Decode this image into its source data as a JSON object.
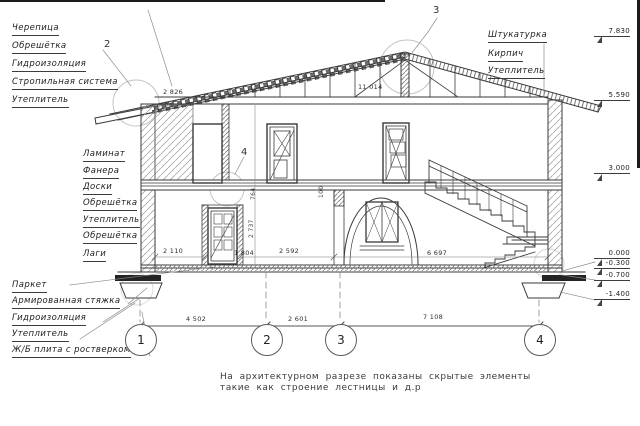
{
  "labels": {
    "roof": [
      "Черепица",
      "Обрешётка",
      "Гидроизоляция",
      "Стропильная система",
      "Утеплитель"
    ],
    "floor": [
      "Ламинат",
      "Фанера",
      "Доски",
      "Обрешётка",
      "Утеплитель",
      "Обрешётка",
      "Лаги"
    ],
    "ground": [
      "Паркет",
      "Армированная стяжка",
      "Гидроизоляция",
      "Утеплитель",
      "Ж/Б плита с ростверком"
    ],
    "wall_right": [
      "Штукатурка",
      "Кирпич",
      "Утеплитель"
    ]
  },
  "elevations": [
    "7.830",
    "5.590",
    "3.000",
    "0.000",
    "-0.300",
    "-0.700",
    "-1.400"
  ],
  "grid_axes": [
    "1",
    "2",
    "3",
    "4"
  ],
  "detail_markers": [
    "2",
    "3",
    "4"
  ],
  "dims": {
    "axis_1_2": "4 502",
    "axis_2_3": "2 601",
    "axis_3_4": "7 108",
    "roof_left": "2 826",
    "attic_span": "11 014",
    "room_left": "2 110",
    "door_width": "1 804",
    "room_mid": "2 592",
    "room_right": "6 697",
    "door_height": "2 737",
    "transom": "764",
    "beam": "100"
  },
  "note": {
    "line1": "На архитектурном разрезе показаны скрытые элементы",
    "line2": "такие как строение лестницы и д.р"
  },
  "colors": {
    "line": "#3a3a3a",
    "detail_circle": "#c4c4c4"
  }
}
